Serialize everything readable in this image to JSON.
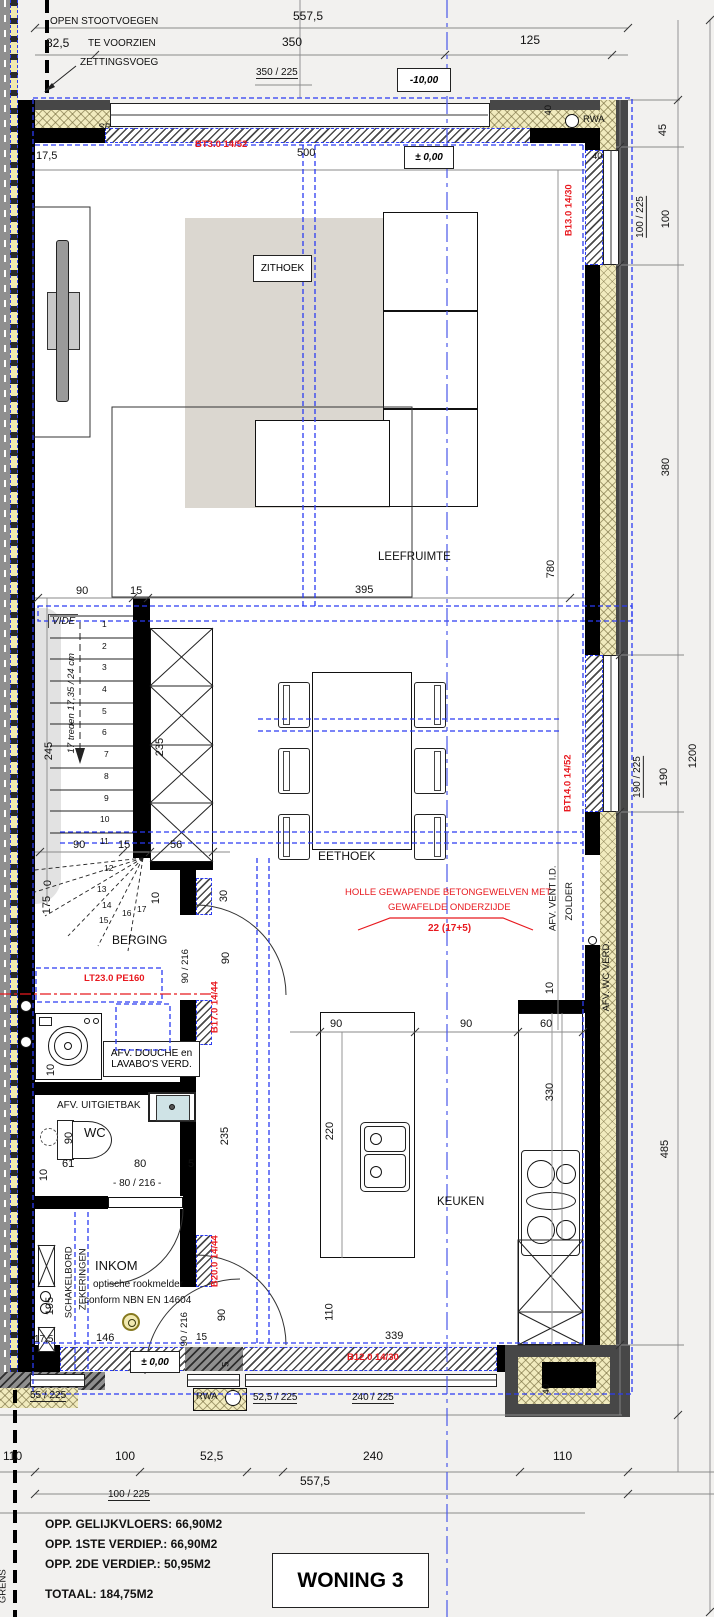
{
  "title": "WONING 3",
  "areas": {
    "l1": "OPP. GELIJKVLOERS: 66,90M2",
    "l2": "OPP. 1STE VERDIEP.: 66,90M2",
    "l3": "OPP. 2DE VERDIEP.: 50,95M2",
    "total": "TOTAAL: 184,75M2"
  },
  "rooms": {
    "zithoek": "ZITHOEK",
    "leefruimte": "LEEFRUIMTE",
    "eethoek": "EETHOEK",
    "berging": "BERGING",
    "wc": "WC",
    "inkom": "INKOM",
    "keuken": "KEUKEN"
  },
  "levels": {
    "street": "-10,00",
    "ground": "± 0,00",
    "entry": "± 0,00"
  },
  "notes": {
    "open1": "OPEN STOOTVOEGEN",
    "open2": "TE VOORZIEN",
    "zetting": "ZETTINGSVOEG",
    "sr": "SR",
    "rwa_top": "RWA",
    "rwa_bottom": "RWA",
    "vide": "VIDE",
    "stair": "17 treden 17,35 / 24 cm",
    "afv_vent": "AFV. VENT I.D.",
    "zolder": "ZOLDER",
    "afv_wc": "AFV. WC VERD.",
    "afv_douche1": "AFV. DOUCHE en",
    "afv_douche2": "LAVABO'S VERD.",
    "afv_uitgietbak": "AFV. UITGIETBAK",
    "rook1": "optische rookmelder",
    "rook2": "conform NBN EN 14604",
    "schakelbord": "SCHAKELBORD",
    "zekeringen": "ZEKERINGEN",
    "grens": "GRENS"
  },
  "red": {
    "bt3": "BT3.0 14/52",
    "b13": "B13.0 14/30",
    "bt14": "BT14.0 14/52",
    "b17": "B17.0 14/44",
    "b20": "B20.0 14/44",
    "b12": "B12.0 14/30",
    "lt23": "LT23.0 PE160",
    "slab1": "HOLLE GEWAPENDE BETONGEWELVEN MET",
    "slab2": "GEWAFELDE ONDERZIJDE",
    "slab3": "22 (17+5)"
  },
  "stair_numbers": [
    "1",
    "2",
    "3",
    "4",
    "5",
    "6",
    "7",
    "8",
    "9",
    "10",
    "11",
    "12",
    "13",
    "14",
    "15",
    "16",
    "17"
  ],
  "dims": {
    "top_total": "557,5",
    "top_350": "350",
    "top_825": "82,5",
    "top_125": "125",
    "top_win": "350 / 225",
    "jog": "17,5",
    "win500": "500",
    "r45": "45",
    "rwin1": "100 / 225",
    "r100": "100",
    "r380": "380",
    "rwin2": "190 / 225",
    "r190": "190",
    "r1200": "1200",
    "r485": "485",
    "d40a": "40",
    "d40b": "40",
    "d40c": "40",
    "mid90": "90",
    "mid15": "15",
    "mid395": "395",
    "mid780": "780",
    "s245": "245",
    "s235": "235",
    "s90": "90",
    "s15": "15",
    "s56": "56",
    "s175": "175",
    "s0": "0",
    "s10": "10",
    "s30": "30",
    "s90b": "90",
    "sdoor": "90 / 216",
    "wm10": "10",
    "wc90": "90",
    "wc61": "61",
    "wc80": "80",
    "wc5": "5",
    "wc10": "10",
    "wcdoor": "- 80 / 216 -",
    "wc235": "235",
    "i195": "195",
    "i175": "17,5",
    "i146": "146",
    "idoor": "90 / 216",
    "i15": "15",
    "i90": "90",
    "i5": "5",
    "k90a": "90",
    "k90b": "90",
    "k60": "60",
    "k10": "10",
    "k220": "220",
    "k330": "330",
    "k110": "110",
    "k339": "339",
    "bwin1": "55 / 225",
    "bwin2": "52,5 / 225",
    "bwin3": "240 / 225",
    "b110a": "110",
    "b100": "100",
    "b525": "52,5",
    "b240": "240",
    "b110b": "110",
    "b_total": "557,5",
    "b_party": "100 / 225"
  }
}
